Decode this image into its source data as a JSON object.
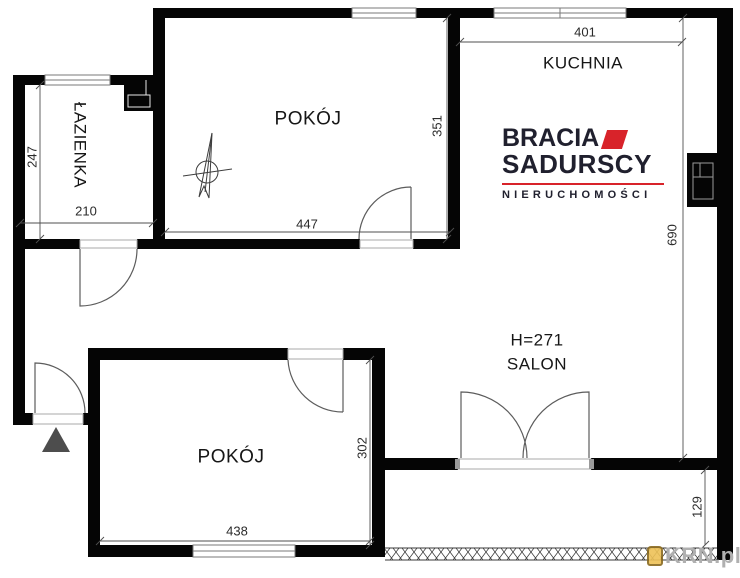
{
  "rooms": {
    "bathroom": {
      "label": "ŁAZIENKA"
    },
    "room_top": {
      "label": "POKÓJ"
    },
    "kitchen": {
      "label": "KUCHNIA"
    },
    "salon": {
      "label": "SALON",
      "ceiling_height": "H=271"
    },
    "room_bottom": {
      "label": "POKÓJ"
    }
  },
  "dimensions": {
    "kitchen_width": "401",
    "room_top_width": "447",
    "room_top_height": "351",
    "bathroom_width": "210",
    "bathroom_height": "247",
    "right_side_height": "690",
    "room_bottom_width": "438",
    "room_bottom_height": "302",
    "balcony_depth": "129"
  },
  "logo": {
    "line1": "BRACIA",
    "line2": "SADURSCY",
    "line3": "NIERUCHOMOŚCI",
    "accent_color": "#d8232a",
    "text_color": "#20202e"
  },
  "watermark": {
    "text": "KRN.pl"
  }
}
